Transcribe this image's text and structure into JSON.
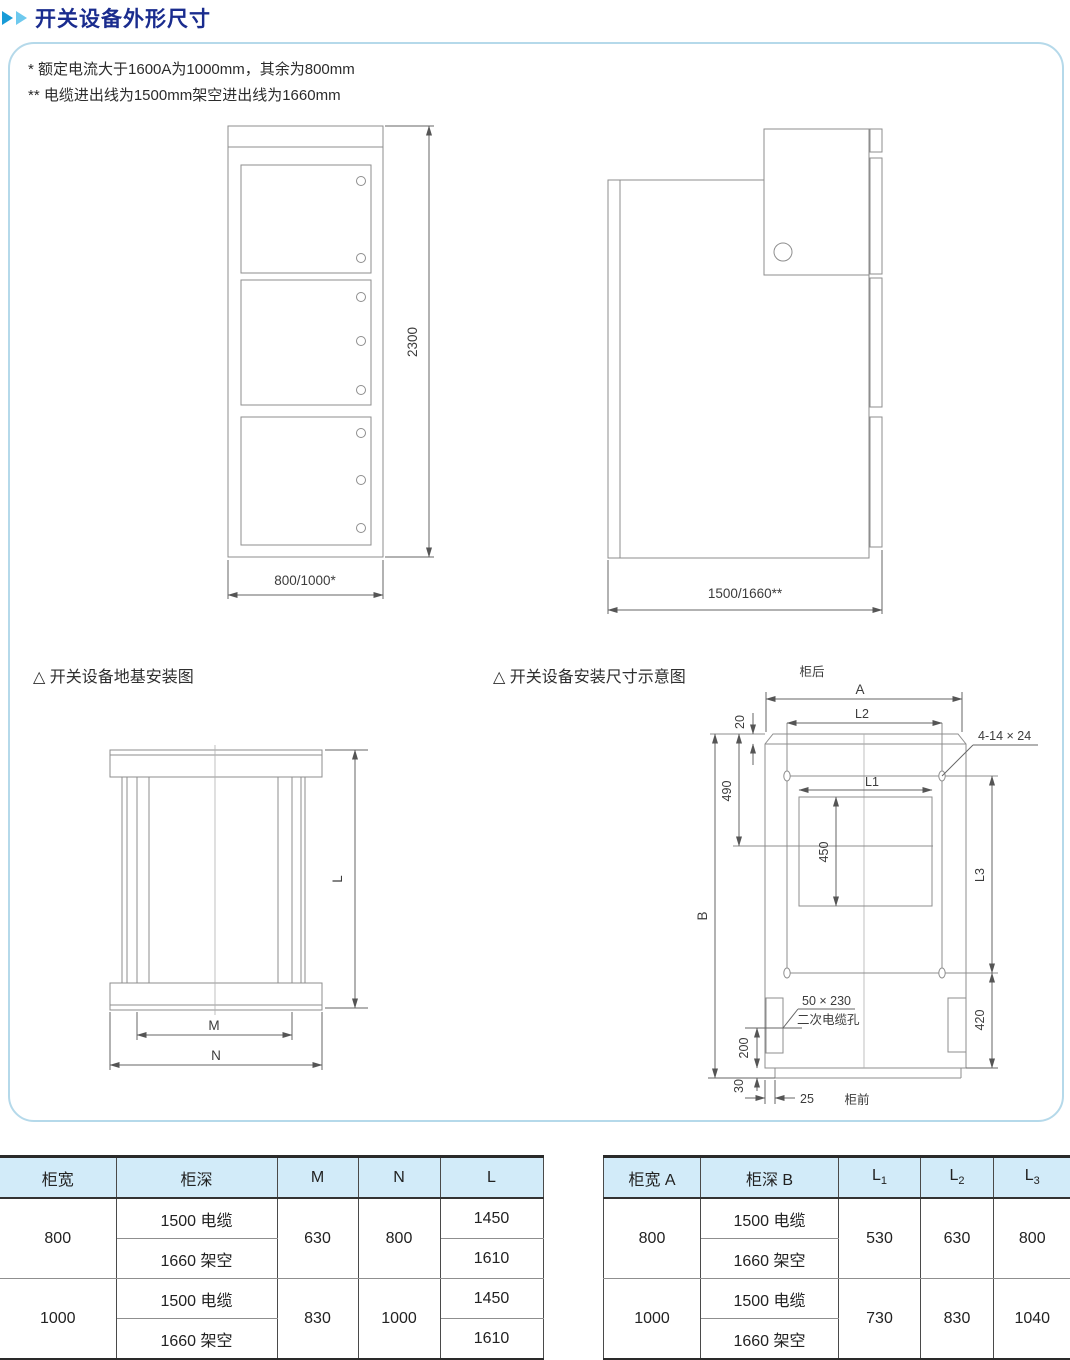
{
  "page": {
    "title": "开关设备外形尺寸",
    "notes": [
      "* 额定电流大于1600A为1000mm，其余为800mm",
      "** 电缆进出线为1500mm架空进出线为1660mm"
    ],
    "accent_colors": {
      "title_navy": "#1a2c8e",
      "arrow_blue": "#189bd7",
      "arrow_light_blue": "#6ec9ee",
      "panel_border": "#b5d9ea",
      "table_header_bg": "#d2ebf9"
    }
  },
  "diagrams": {
    "front_view": {
      "height_dim": "2300",
      "width_dim": "800/1000*"
    },
    "side_view": {
      "depth_dim": "1500/1660**"
    },
    "foundation": {
      "title": "△ 开关设备地基安装图",
      "dim_l": "L",
      "dim_m": "M",
      "dim_n": "N"
    },
    "installation": {
      "title": "△ 开关设备安装尺寸示意图",
      "rear_label": "柜后",
      "front_label": "柜前",
      "dim_a": "A",
      "dim_b": "B",
      "dim_20": "20",
      "dim_490": "490",
      "dim_450": "450",
      "dim_l1": "L1",
      "dim_l2": "L2",
      "dim_l3": "L3",
      "dim_420": "420",
      "dim_200": "200",
      "dim_30": "30",
      "dim_25": "25",
      "hole_label": "4-14 × 24",
      "cable_hole_size": "50 × 230",
      "cable_hole_name": "二次电缆孔"
    }
  },
  "left_table": {
    "headers": [
      "柜宽",
      "柜深",
      "M",
      "N",
      "L"
    ],
    "groups": [
      {
        "width": "800",
        "depths": [
          "1500 电缆",
          "1660 架空"
        ],
        "m": "630",
        "n": "800",
        "l": [
          "1450",
          "1610"
        ]
      },
      {
        "width": "1000",
        "depths": [
          "1500 电缆",
          "1660 架空"
        ],
        "m": "830",
        "n": "1000",
        "l": [
          "1450",
          "1610"
        ]
      }
    ]
  },
  "right_table": {
    "headers": {
      "width": "柜宽 A",
      "depth": "柜深 B",
      "l1base": "L",
      "l1sub": "1",
      "l2base": "L",
      "l2sub": "2",
      "l3base": "L",
      "l3sub": "3"
    },
    "groups": [
      {
        "width": "800",
        "depths": [
          "1500 电缆",
          "1660 架空"
        ],
        "l1": "530",
        "l2": "630",
        "l3": "800"
      },
      {
        "width": "1000",
        "depths": [
          "1500 电缆",
          "1660 架空"
        ],
        "l1": "730",
        "l2": "830",
        "l3": "1040"
      }
    ]
  }
}
